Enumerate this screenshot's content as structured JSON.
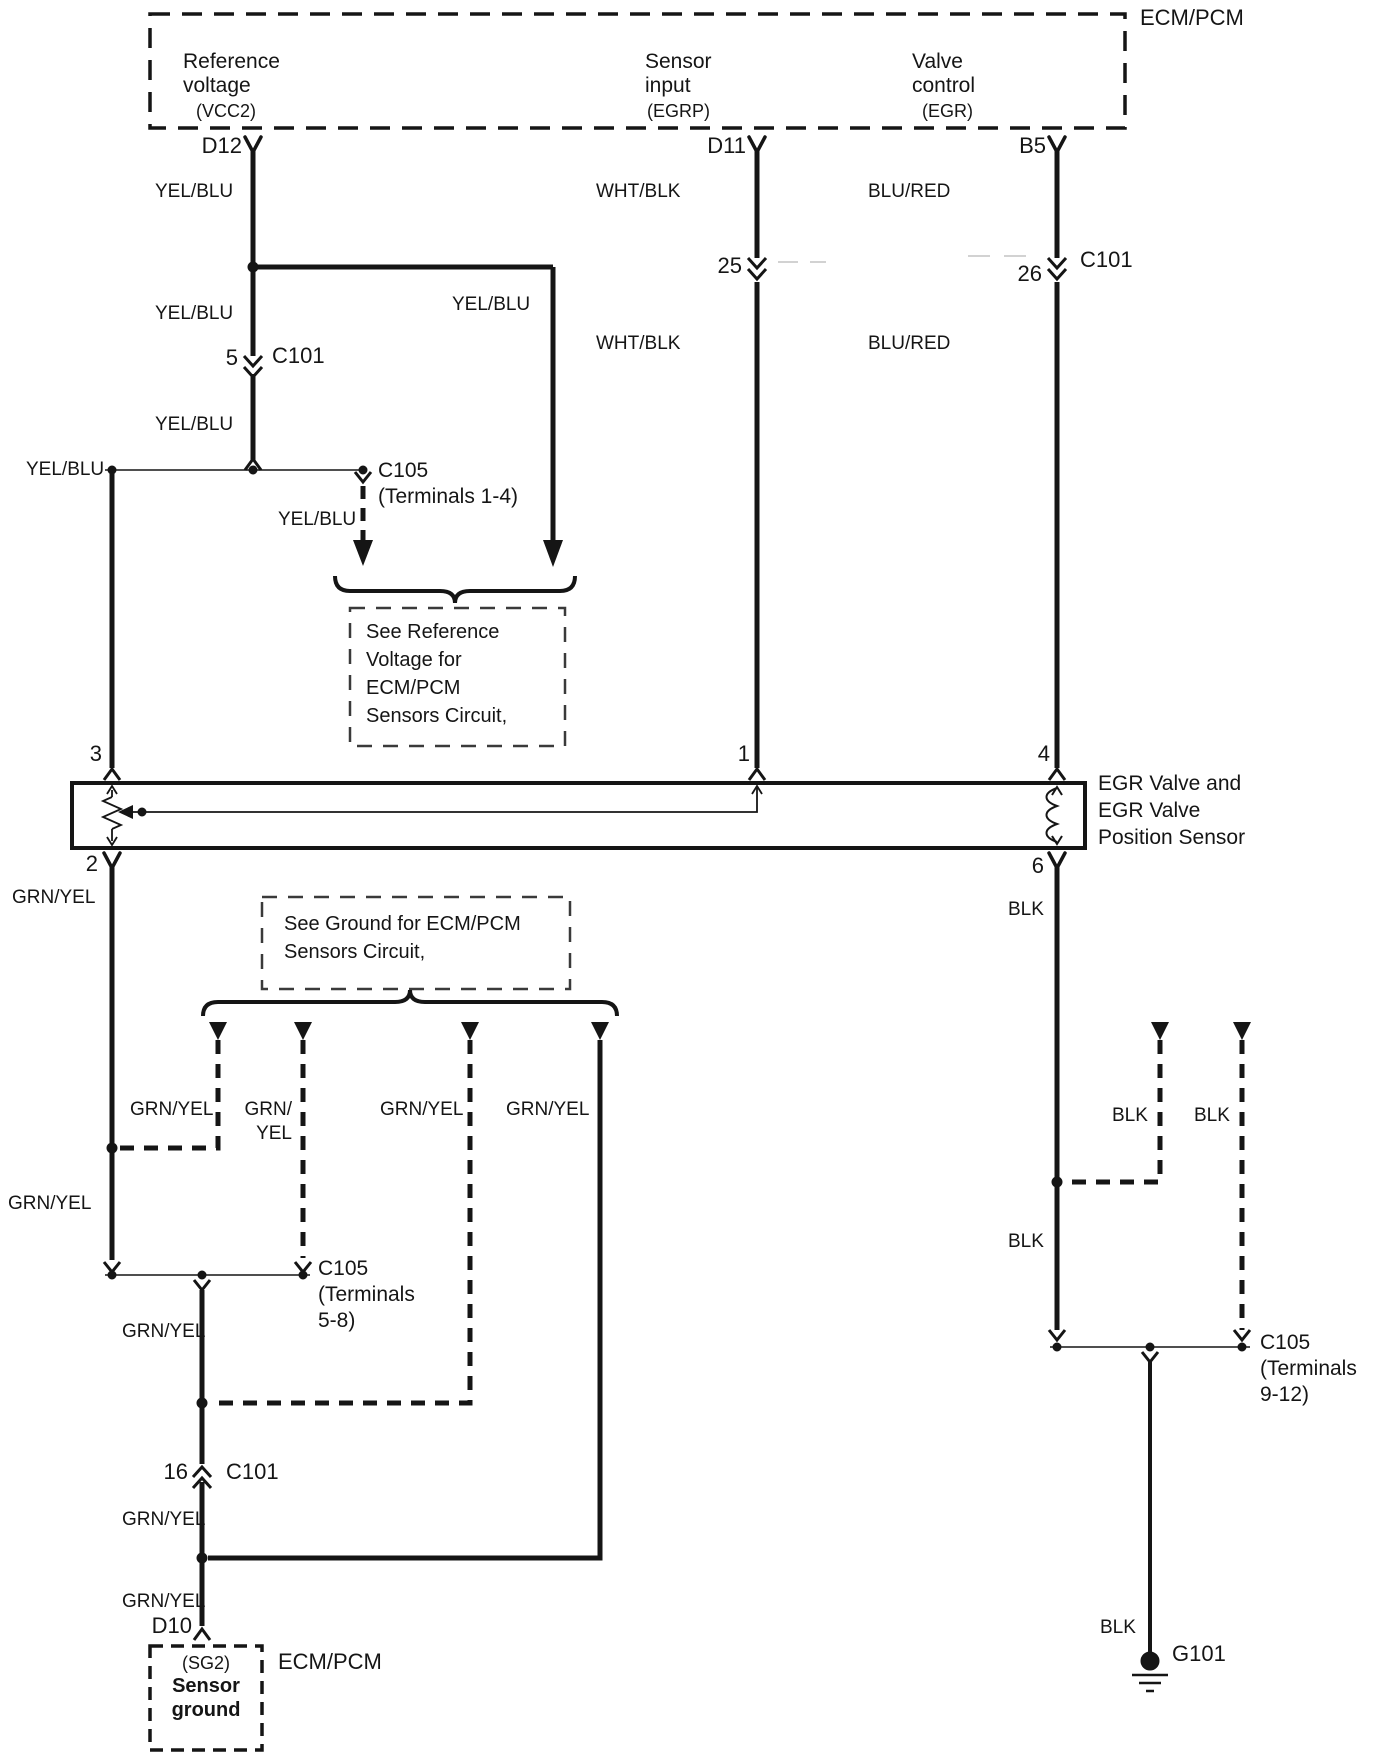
{
  "ecm": {
    "label": "ECM/PCM",
    "pins": [
      {
        "id": "D12",
        "function": "Reference\nvoltage",
        "signal": "(VCC2)"
      },
      {
        "id": "D11",
        "function": "Sensor\ninput",
        "signal": "(EGRP)"
      },
      {
        "id": "B5",
        "function": "Valve\ncontrol",
        "signal": "(EGR)"
      }
    ]
  },
  "wire_colors": {
    "yel_blu": "YEL/BLU",
    "wht_blk": "WHT/BLK",
    "blu_red": "BLU/RED",
    "grn_yel": "GRN/YEL",
    "grn_yel_wrapped": "GRN/\nYEL",
    "blk": "BLK"
  },
  "connectors": {
    "c101": "C101",
    "t5": "5",
    "t16": "16",
    "t25": "25",
    "t26": "26",
    "c105_terminals_1_4": "C105\n(Terminals 1-4)",
    "c105_terminals_5_8": "C105\n(Terminals\n5-8)",
    "c105_terminals_9_12": "C105\n(Terminals\n9-12)"
  },
  "egr_valve": {
    "label": "EGR Valve and\nEGR Valve\nPosition Sensor",
    "pin_3": "3",
    "pin_1": "1",
    "pin_4": "4",
    "pin_2": "2",
    "pin_6": "6"
  },
  "notes": {
    "reference_voltage": "See Reference\nVoltage for\nECM/PCM\nSensors Circuit,",
    "ground": "See Ground for ECM/PCM\nSensors Circuit,"
  },
  "ecm_bottom": {
    "label": "ECM/PCM",
    "pin": "D10",
    "signal": "(SG2)",
    "function": "Sensor\nground"
  },
  "ground_point": {
    "label": "G101"
  }
}
